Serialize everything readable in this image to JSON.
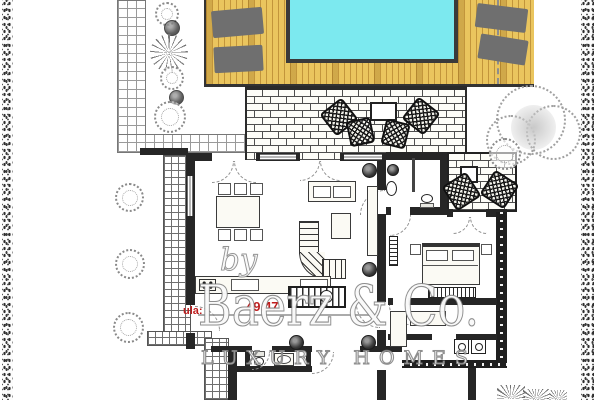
{
  "watermark": {
    "prefix": "by",
    "brand": "Baerz & Co.",
    "tagline": "LUXURY HOMES"
  },
  "plan_labels": {
    "entrance": "ula:",
    "entrance_area": "49.47"
  },
  "colors": {
    "pool": "#7ce9ef",
    "pool-border": "#3a3a3a",
    "deck": "#eac55e",
    "deck-line": "#c2953b",
    "lounger": "#6f6f6f",
    "wall": "#262626",
    "mortar": "#4f4f4f",
    "tile-line": "#9a9a9a",
    "dense-tile-line": "#6f6f6f",
    "sketch": "#8a8a8a",
    "label-red": "#bf1d1d",
    "watermark-stroke": "#7f7f7f"
  },
  "symbols": {
    "pool": "cyan-rectangle",
    "deck": "wood-plank-stripes",
    "sun-lounger": "gray-rounded-rect",
    "bush": "dotted-circle-sketch",
    "tree": "dotted-cloud-sketch",
    "agave": "ray-burst",
    "wicker-chair": "crosshatched-square",
    "staircase": "striped-rect-with-circle",
    "radiator": "striped-rect",
    "washer-dryer": "square-with-circle",
    "toilet": "ellipse-with-tank",
    "sink": "oval-in-rect",
    "bed": "rect-with-pillows",
    "boundary-hedge": "speckled-strip",
    "paving": "brick-pattern",
    "path": "tile-grid"
  }
}
